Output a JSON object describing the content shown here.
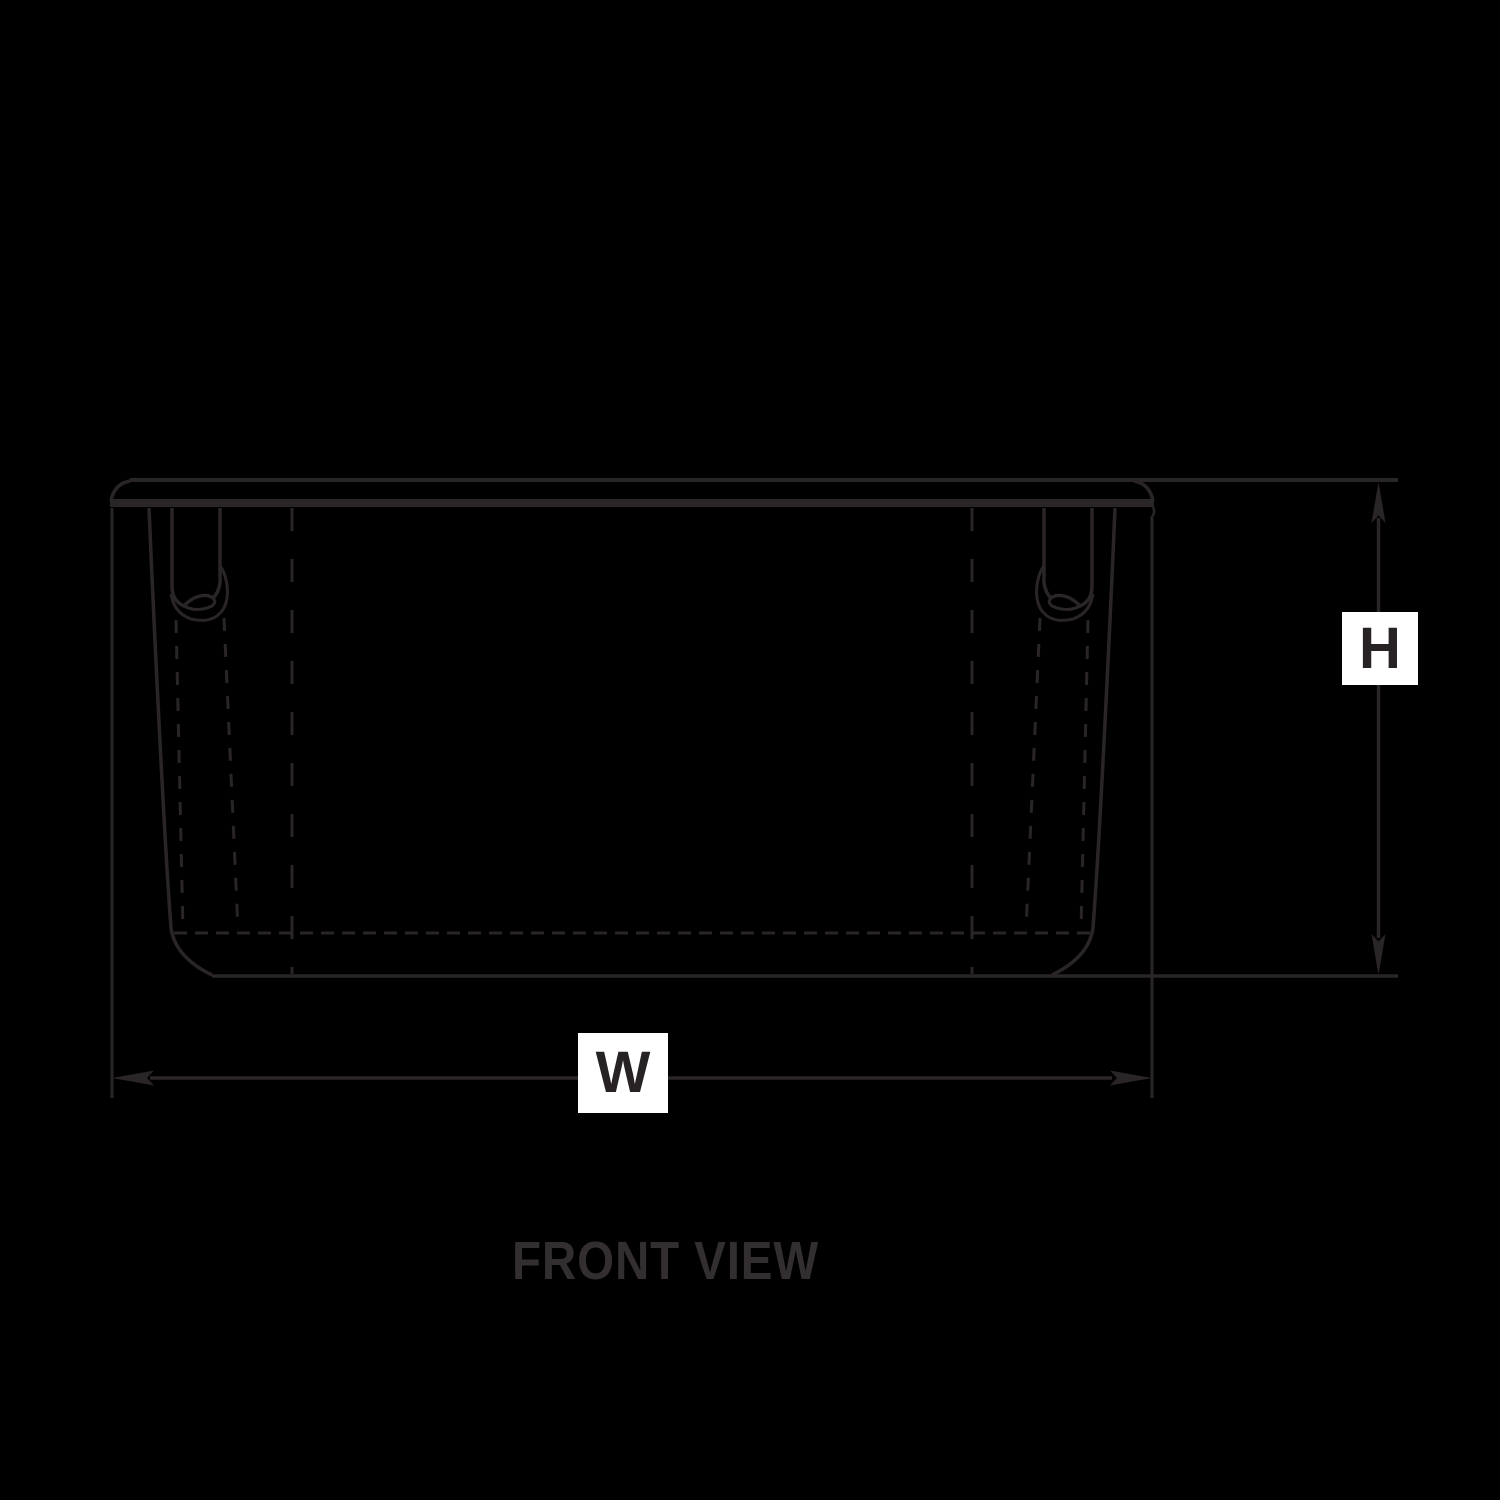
{
  "diagram": {
    "type": "technical-drawing",
    "caption": "FRONT VIEW",
    "subject": "storage-tote-front-view",
    "dimensions": {
      "width_label": "W",
      "height_label": "H"
    },
    "colors": {
      "background": "#000000",
      "line": "#2a2526",
      "label_box": "#ffffff",
      "label_text": "#272324",
      "caption": "#332e2f"
    }
  }
}
